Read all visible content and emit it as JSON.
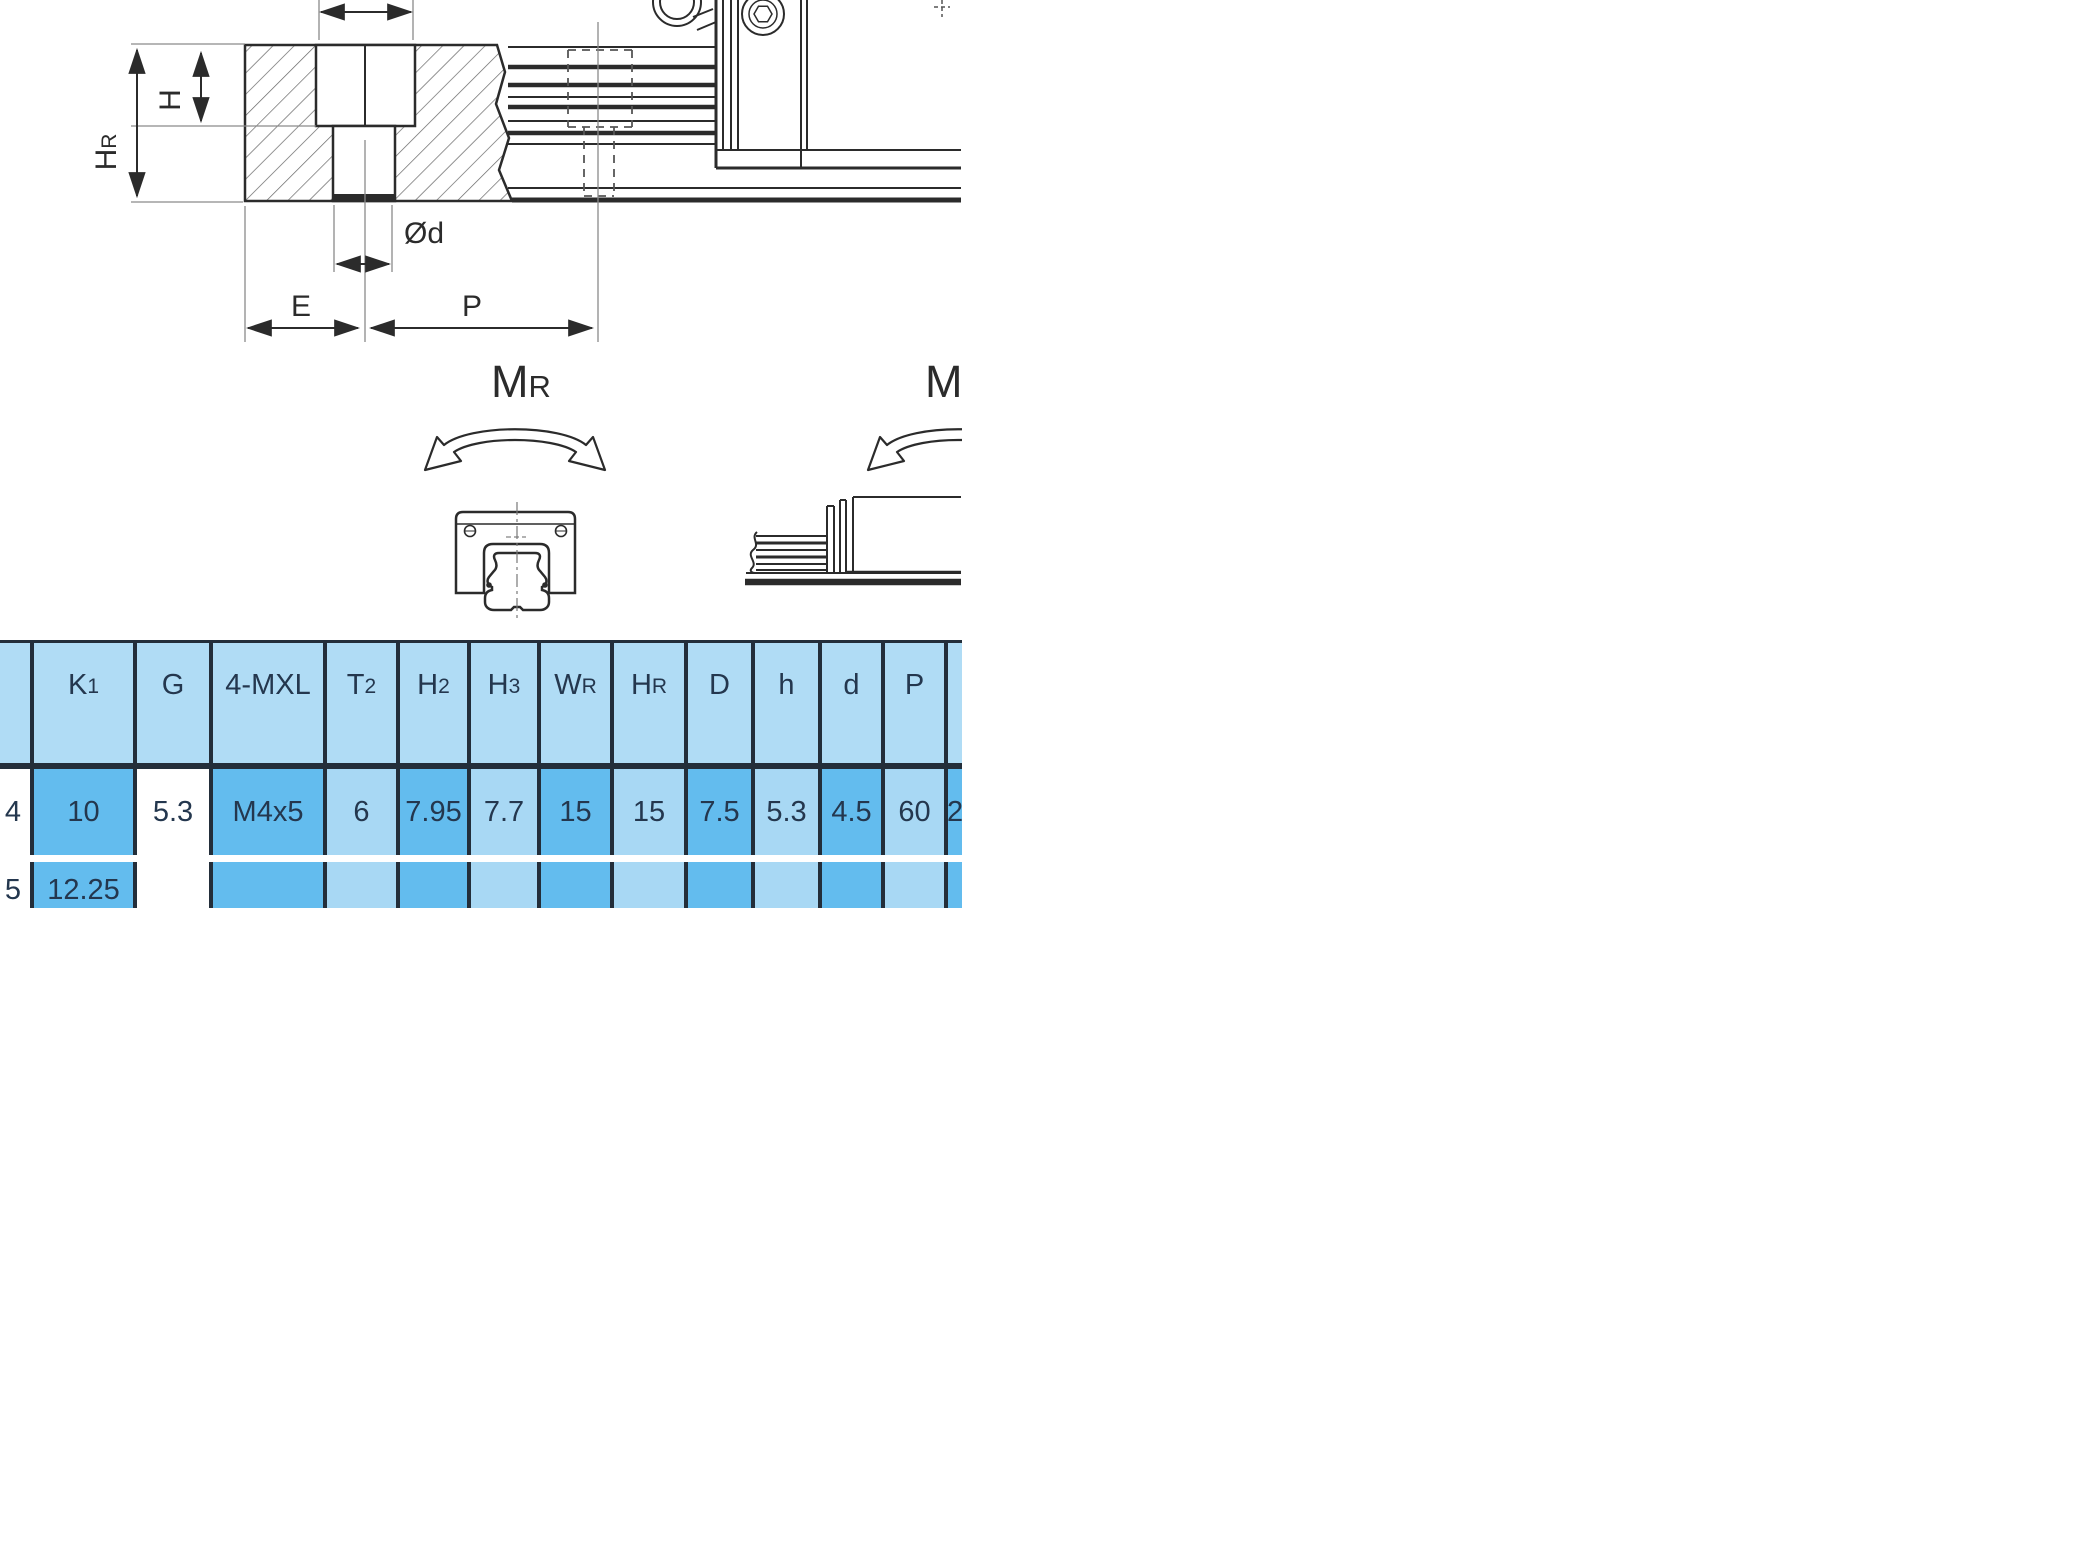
{
  "drawing": {
    "labels": {
      "dim_hr_main": "H",
      "dim_hr_sub": "R",
      "dim_h": "H",
      "dim_od": "Ød",
      "dim_e": "E",
      "dim_p": "P",
      "mr_left_main": "M",
      "mr_left_sub": "R",
      "mr_right_main": "M",
      "mr_right_sub": "R"
    },
    "colors": {
      "line": "#2b2b2b",
      "thin": "#8a8a8a",
      "hatch": "#666666"
    }
  },
  "table": {
    "colors": {
      "border": "#232e3a",
      "header_bg": "#b0dcf5",
      "dark_bg": "#63bcee",
      "light_bg": "#a8d8f4",
      "white_bg": "#ffffff",
      "text": "#24374e"
    },
    "columns": [
      {
        "width": 30,
        "header": {
          "main": "",
          "sub": ""
        },
        "body": "white"
      },
      {
        "width": 103,
        "header": {
          "main": "K",
          "sub": "1"
        },
        "body": "dark"
      },
      {
        "width": 76,
        "header": {
          "main": "G",
          "sub": ""
        },
        "body": "white"
      },
      {
        "width": 114,
        "header": {
          "main": "4-MXL",
          "sub": ""
        },
        "body": "dark"
      },
      {
        "width": 73,
        "header": {
          "main": "T",
          "sub": "2"
        },
        "body": "light"
      },
      {
        "width": 71,
        "header": {
          "main": "H",
          "sub": "2"
        },
        "body": "dark"
      },
      {
        "width": 70,
        "header": {
          "main": "H",
          "sub": "3"
        },
        "body": "light"
      },
      {
        "width": 73,
        "header": {
          "main": "W",
          "sub": "R"
        },
        "body": "dark"
      },
      {
        "width": 74,
        "header": {
          "main": "H",
          "sub": "R"
        },
        "body": "light"
      },
      {
        "width": 67,
        "header": {
          "main": "D",
          "sub": ""
        },
        "body": "dark"
      },
      {
        "width": 67,
        "header": {
          "main": "h",
          "sub": ""
        },
        "body": "light"
      },
      {
        "width": 63,
        "header": {
          "main": "d",
          "sub": ""
        },
        "body": "dark"
      },
      {
        "width": 63,
        "header": {
          "main": "P",
          "sub": ""
        },
        "body": "light"
      },
      {
        "width": 18,
        "header": {
          "main": "",
          "sub": ""
        },
        "body": "dark"
      }
    ],
    "rows": [
      [
        "4",
        "10",
        "5.3",
        "M4x5",
        "6",
        "7.95",
        "7.7",
        "15",
        "15",
        "7.5",
        "5.3",
        "4.5",
        "60",
        "2"
      ],
      [
        "5",
        "12.25",
        "",
        "",
        "",
        "",
        "",
        "",
        "",
        "",
        "",
        "",
        "",
        ""
      ]
    ]
  }
}
